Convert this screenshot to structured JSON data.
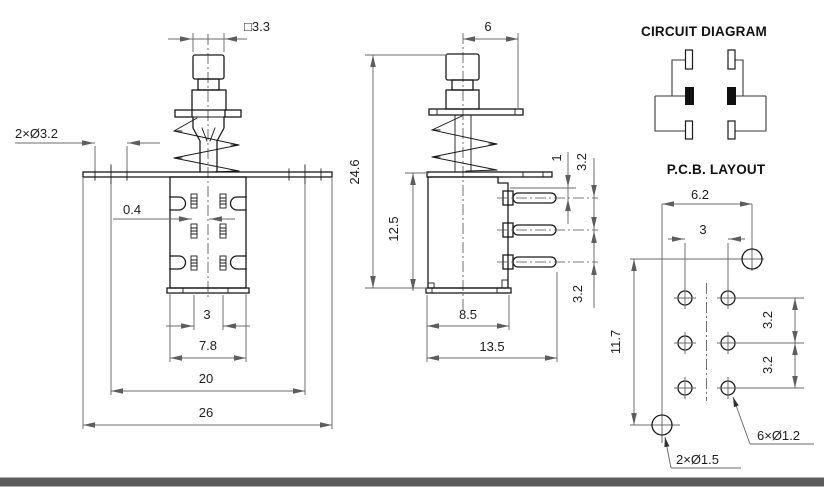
{
  "front_view": {
    "dim_square": "□3.3",
    "dim_holes": "2×Ø3.2",
    "dim_pin_offset": "0.4",
    "dim_pin_pitch": "3",
    "dim_body_width": "7.8",
    "dim_mount_spacing": "20",
    "dim_flange_width": "26"
  },
  "side_view": {
    "dim_stem_offset": "6",
    "dim_total_height": "24.6",
    "dim_body_height": "12.5",
    "dim_pin_root": "1",
    "dim_pin_pitch_upper": "3.2",
    "dim_pin_pitch_lower": "3.2",
    "dim_body_depth": "8.5",
    "dim_total_depth": "13.5"
  },
  "circuit_diagram": {
    "title": "CIRCUIT DIAGRAM"
  },
  "pcb_layout": {
    "title": "P.C.B. LAYOUT",
    "dim_hole_span_x": "6.2",
    "dim_pad_pitch_x": "3",
    "dim_hole_span_y": "11.7",
    "dim_pad_pitch_y1": "3.2",
    "dim_pad_pitch_y2": "3.2",
    "label_pad_holes": "6×Ø1.2",
    "label_mount_holes": "2×Ø1.5"
  },
  "colors": {
    "outline": "#1a1a1a",
    "dimension": "#6a6a6a",
    "footer_bar": "#5c5c5c",
    "background": "#ffffff"
  }
}
